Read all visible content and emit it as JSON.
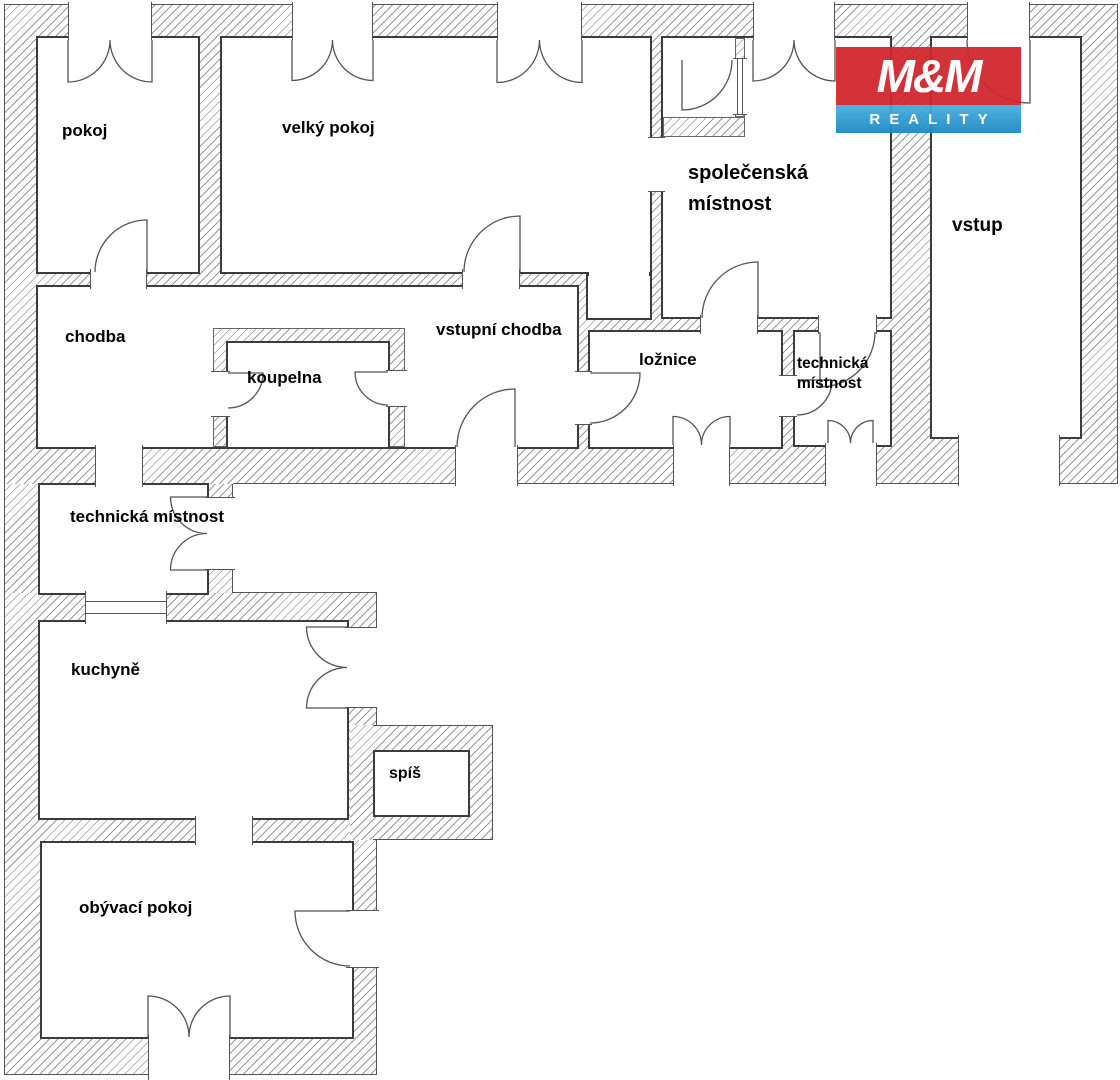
{
  "logo": {
    "title": "M&M",
    "subtitle": "REALITY",
    "red": "#d2262d",
    "blue": "#2d9bd5"
  },
  "colors": {
    "wall_line": "#555555",
    "hatch": "#9a9a9a",
    "label": "#000000"
  },
  "rooms": {
    "pokoj": {
      "label": "pokoj"
    },
    "velky_pokoj": {
      "label": "velký pokoj"
    },
    "spolecenska_mistnost": {
      "line1": "společenská",
      "line2": "místnost"
    },
    "vstup": {
      "label": "vstup"
    },
    "chodba": {
      "label": "chodba"
    },
    "koupelna": {
      "label": "koupelna"
    },
    "vstupni_chodba": {
      "label": "vstupní chodba"
    },
    "loznice": {
      "label": "ložnice"
    },
    "technicka_mistnost_right": {
      "line1": "technická",
      "line2": "místnost"
    },
    "technicka_mistnost_left": {
      "label": "technická místnost"
    },
    "kuchyne": {
      "label": "kuchyně"
    },
    "spis": {
      "label": "spíš"
    },
    "obyvaci_pokoj": {
      "label": "obývací pokoj"
    }
  }
}
